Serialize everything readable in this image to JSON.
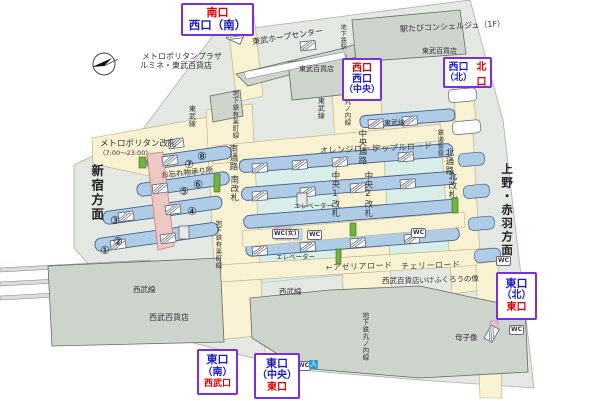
{
  "exits": {
    "minami": {
      "line1": "南口",
      "line2": "西口（南）"
    },
    "nishi_chuo": {
      "line1": "西口",
      "line2": "西口",
      "line3": "（中央）"
    },
    "nishi_kita": {
      "line1": "西口",
      "line2": "（北）",
      "right": "北口"
    },
    "higashi_kita": {
      "line1": "東口",
      "line2": "（北）",
      "line3": "東口"
    },
    "higashi_minami": {
      "line1": "東口",
      "line2": "（南）",
      "line3": "西武口"
    },
    "higashi_chuo": {
      "line1": "東口",
      "line2": "（中央）",
      "line3": "東口"
    }
  },
  "directions": {
    "shinjuku": "新宿方面",
    "ueno_akabane": "上野・赤羽方面"
  },
  "roads": {
    "orange": "オレンジロード",
    "apple": "アップルロード",
    "azalea": "←アゼリアロード",
    "cherry": "チェリーロード"
  },
  "gates": {
    "metropolitan": "メトロポリタン改札",
    "metropolitan_hours": "（7:00～23:00）",
    "minami_tsuro": "南通路",
    "minami_kaisatsu": "南改札",
    "chuo_tsuro": "中央通路",
    "chuo1_kaisatsu": "中央1改札",
    "chuo2_kaisatsu": "中央2改札",
    "kita_tsuro": "北通路",
    "kita_kaisatsu": "北改札"
  },
  "lines": {
    "tobu_left": "東武線",
    "tobu_center": "東武線",
    "tobu_right": "東武線",
    "yurakucho_top": "地下鉄有楽町線",
    "yurakucho_south": "地下鉄有楽町線",
    "marunouchi_center": "丸ノ内線",
    "marunouchi_south": "地下鉄丸ノ内線",
    "chikatetsu_eki": "地下鉄駅",
    "seibu_left": "西武線",
    "seibu_right": "西武線"
  },
  "buildings": {
    "metropolitan_plaza": "メトロポリタンプラザ",
    "lumine_tobu": "ルミネ・東武百貨店",
    "tobu_hope_center": "東武ホープセンター",
    "tobu_dept_top": "東武百貨店",
    "tobu_dept_right": "東武百貨店",
    "eki_tabi": "駅たびコンシェルジュ（1F）",
    "seibu_dept_left": "西武百貨店",
    "seibu_dept_right": "西武百貨店"
  },
  "facilities": {
    "owasuremono": "お忘れ物承り所",
    "elevator1": "エレベーター",
    "elevator2": "エレベーター",
    "police": "鉄道警察",
    "ikefukuro": "いけふくろうの像",
    "boshizo": "母子像",
    "wc": "WC",
    "wc_women": "WC(女)",
    "accessible": "人"
  },
  "platform_numbers": {
    "n1": "①",
    "n2": "②",
    "n3": "③",
    "n4": "④",
    "n5": "⑤",
    "n6": "⑥",
    "n7": "⑦",
    "n8": "⑧"
  },
  "colors": {
    "label_border_purple": "#7b2ee0",
    "exit_red": "#dd0000",
    "exit_blue": "#1a18c8",
    "platform_blue": "#aecce6",
    "concourse_cream": "#f9f2d2",
    "building_gray": "#cdd4cc",
    "backdrop_gray": "#e3e8e2",
    "track_cyan": "#daeee9",
    "corridor_pink": "#eec7c3",
    "escalator_green": "#72b240"
  }
}
